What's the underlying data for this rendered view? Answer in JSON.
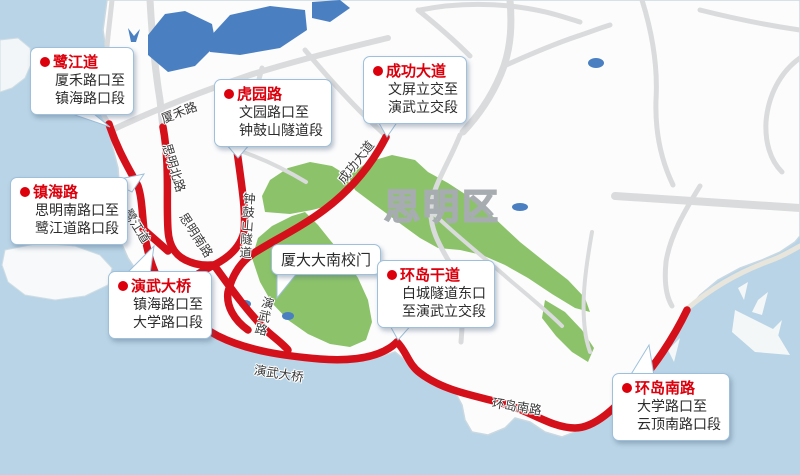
{
  "map": {
    "district_label": "思明区",
    "poi_label": "厦大大南校门",
    "road_labels": {
      "xiahe": "厦禾路",
      "siming_north": "思明北路",
      "lujiang": "鹭江道",
      "siming_south": "思明南路",
      "zhonggushan": "钟鼓山隧道",
      "chenggong": "成功大道",
      "yanwu_road": "演武路",
      "yanwu_bridge": "演武大桥",
      "huandao_south": "环岛南路"
    },
    "callouts": {
      "lujiangdao": {
        "title": "鹭江道",
        "body": [
          "厦禾路口至",
          "镇海路口段"
        ]
      },
      "huyuanlu": {
        "title": "虎园路",
        "body": [
          "文园路口至",
          "钟鼓山隧道段"
        ]
      },
      "chenggongdadao": {
        "title": "成功大道",
        "body": [
          "文屏立交至",
          "演武立交段"
        ]
      },
      "zhenhailu": {
        "title": "镇海路",
        "body": [
          "思明南路口至",
          "鹭江道路口段"
        ]
      },
      "yanwudaqiao": {
        "title": "演武大桥",
        "body": [
          "镇海路口至",
          "大学路口段"
        ]
      },
      "huandaogandao": {
        "title": "环岛干道",
        "body": [
          "白城隧道东口",
          "至演武立交段"
        ]
      },
      "huandaonanlu": {
        "title": "环岛南路",
        "body": [
          "大学路口至",
          "云顶南路口段"
        ]
      }
    },
    "colors": {
      "water": "#b9d4e6",
      "land": "#fcfcfd",
      "park_green": "#8cc36a",
      "highlight_red": "#d4101a",
      "road_gray": "#dadbdc",
      "water_feature_blue": "#4a80c2",
      "callout_title_red": "#dc000c",
      "district_gray": "#a7acb1"
    }
  }
}
